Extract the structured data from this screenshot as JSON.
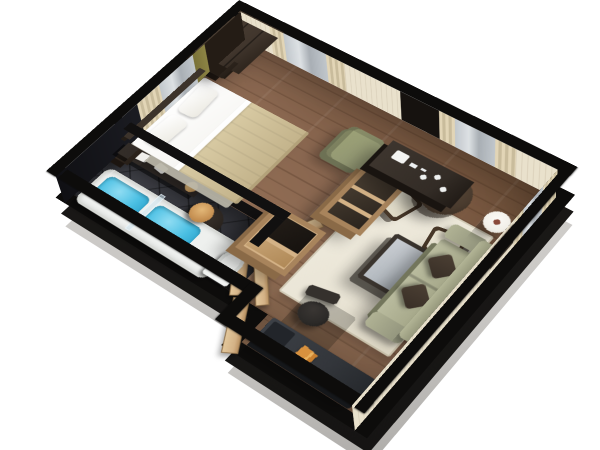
{
  "scene": {
    "kind": "3d-floor-plan-render",
    "view": "isometric-cutaway",
    "rooms": [
      {
        "name": "bedroom",
        "items": [
          "wardrobe",
          "double-bed",
          "pillows",
          "beige-blanket",
          "headboard",
          "nightstand",
          "curtained-window",
          "olive-armchair",
          "coffee-station-console",
          "open-shelf-unit"
        ]
      },
      {
        "name": "bathroom",
        "items": [
          "bathtub-with-water",
          "glass-shower-screen",
          "round-pedestal-basin",
          "gold-bowl",
          "toilet",
          "towel-counter",
          "towels"
        ]
      },
      {
        "name": "hallway",
        "items": [
          "minibar-cabinet",
          "entry-door-open",
          "bathroom-door-open",
          "closet-door-leaves"
        ]
      },
      {
        "name": "living-room",
        "items": [
          "sofa",
          "dark-throw-cushions",
          "area-rug",
          "coffee-table",
          "round-dining-table",
          "plant",
          "upholstered-chair",
          "upholstered-chair",
          "floor-lamp",
          "wall-art-frame",
          "wall-art-frame",
          "desk",
          "office-chair",
          "orange-book"
        ]
      }
    ]
  },
  "colors": {
    "bg": "#ffffff",
    "wallTop": "#0d0c0b",
    "slabDark": "#151413",
    "slabGray": "#c8c6c3",
    "cream": "#e9e1cc",
    "drape": "#e2d5b6",
    "drapeShade": "#c9bc9c",
    "glass": "#c1c7cc",
    "glassHi": "#dde1e4",
    "niche": "#16120f",
    "accent": "#8d8445",
    "wood": "#8a6750",
    "woodHi": "#9f7a5c",
    "woodLo": "#6f5038",
    "tile": "#34353b",
    "rug": "#e9e4d5",
    "tubWhite": "#eef0ee",
    "tubEdge": "#d7d9d5",
    "water": "#4cc0e4",
    "waterDeep": "#2ba3cc",
    "porcelain": "#f2f4f2",
    "vanityDark": "#2c2623",
    "gold": "#c89355",
    "goldDeep": "#a9763c",
    "wardrobe": "#41362d",
    "wardrobeSide": "#241c15",
    "furnDark": "#332c26",
    "headboard": "#3c332b",
    "bedWhite": "#f5f4f0",
    "blanket": "#d8caa3",
    "blanketShade": "#c4b48c",
    "tan": "#d4b286",
    "tanEdge": "#a8845c",
    "sofa": "#a9ab8d",
    "sofaShade": "#84866c",
    "cushion": "#382e26",
    "tableTop": "#b4bac0",
    "tableFrame": "#3a342e",
    "dining": "#4a3b2e",
    "chairFrame": "#473728",
    "plant": "#5e7d3a",
    "lamp": "#f1efe8",
    "mat": "#f4f2ec",
    "frameEdge": "#55493c",
    "desk": "#33363b",
    "deskDark": "#22252a",
    "chairDark": "#2c2a28",
    "book": "#d8913e",
    "armOlive": "#8f9471"
  }
}
